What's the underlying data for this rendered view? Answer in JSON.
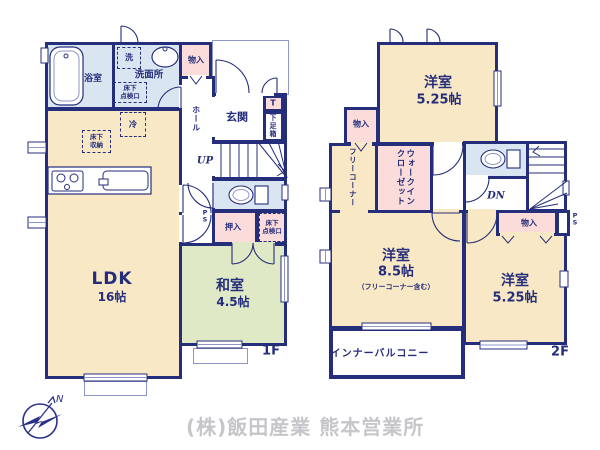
{
  "palette": {
    "wall_navy": "#252e7b",
    "room_cream": "#f8e8c5",
    "tatami_green": "#dfe9c6",
    "wet_area_blue": "#dae5f2",
    "storage_pink": "#fbdcda",
    "company_gray": "#c6c6ca"
  },
  "floor1": {
    "label": "1F",
    "rooms": {
      "bath": "浴室",
      "washroom": "洗面所",
      "laundry": "洗",
      "washroom_hatch": "床下\n点検口",
      "storage_top": "物入",
      "entrance": "玄関",
      "shoe_t": "T",
      "shoe_box": "下足箱",
      "hall": "ホール",
      "stairs_up": "UP",
      "fridge": "冷",
      "underfloor_storage": "床下\n収納",
      "pipe_space": "P\nS",
      "closet": "押入",
      "closet_hatch": "床下\n点検口",
      "ldk": "LDK",
      "ldk_size": "16帖",
      "japanese_room": "和室",
      "japanese_room_size": "4.5帖"
    }
  },
  "floor2": {
    "label": "2F",
    "rooms": {
      "bedroom_top": "洋室",
      "bedroom_top_size": "5.25帖",
      "storage_top": "物入",
      "free_corner": "フリーコーナー",
      "walk_in_closet": "ウォークインクローゼット",
      "stairs_down": "DN",
      "storage_mid": "物入",
      "pipe_space": "P\nS",
      "bedroom_main": "洋室",
      "bedroom_main_size": "8.5帖",
      "bedroom_main_note": "（フリーコーナー含む）",
      "bedroom_right": "洋室",
      "bedroom_right_size": "5.25帖",
      "balcony": "インナーバルコニー"
    }
  },
  "footer": {
    "company": "(株)飯田産業 熊本営業所",
    "compass_n": "N"
  }
}
